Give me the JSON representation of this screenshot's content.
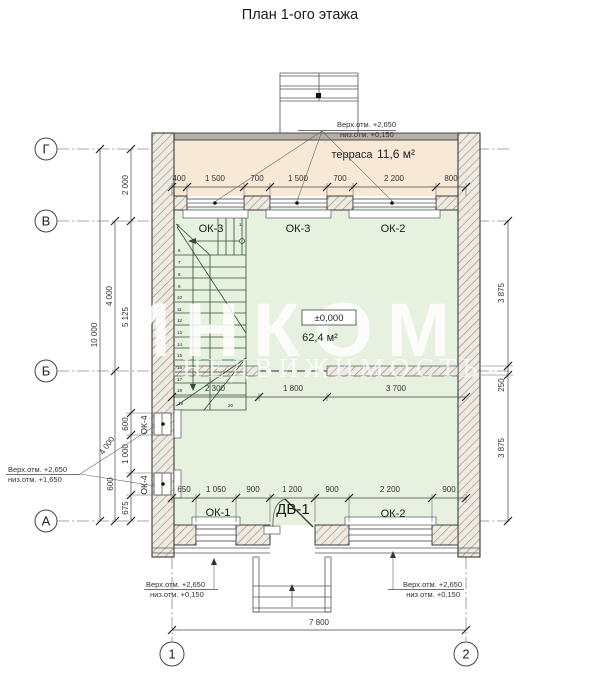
{
  "title": "План 1-ого этажа",
  "colors": {
    "terrace_fill": "#f8e9d7",
    "room_fill": "#e6f1e0",
    "wall_hatch_bg": "#efeae1",
    "wall_edge": "#3a3a3a",
    "watermark": "#ffffff"
  },
  "watermark": {
    "brand": "ИНКОМ",
    "sub": "НЕДВИЖИМОСТЬ"
  },
  "axes": {
    "row_g": "Г",
    "row_v": "В",
    "row_b": "Б",
    "row_a": "А",
    "col_1": "1",
    "col_2": "2"
  },
  "terrace": {
    "name": "терраса",
    "area": "11,6 м²"
  },
  "room": {
    "level": "±0,000",
    "area": "62,4 м²"
  },
  "openings": {
    "ok3a": "ОК-3",
    "ok3b": "ОК-3",
    "ok2_top": "ОК-2",
    "ok1": "ОК-1",
    "dv1": "ДВ-1",
    "ok2_bottom": "ОК-2",
    "ok4a": "ОК-4",
    "ok4b": "ОК-4"
  },
  "dims": {
    "top": [
      "400",
      "1 500",
      "700",
      "1 500",
      "700",
      "2 200",
      "800"
    ],
    "mid": [
      "2 300",
      "1 800",
      "3 700"
    ],
    "bottom": [
      "650",
      "1 050",
      "900",
      "1 200",
      "900",
      "2 200",
      "900"
    ],
    "left_total": "10 000",
    "left_2000": "2 000",
    "left_4000_upper": "4 000",
    "left_5125": "5 125",
    "left_4000_lower": "4 000",
    "left_600a": "600",
    "left_1000": "1 000",
    "left_600b": "600",
    "left_675": "675",
    "right_3875a": "3 875",
    "right_250": "250",
    "right_3875b": "3 875",
    "total_width": "7 800"
  },
  "stairs": {
    "numbers": [
      "1",
      "5",
      "6",
      "7",
      "8",
      "9",
      "10",
      "11",
      "12",
      "13",
      "14",
      "15",
      "16",
      "17",
      "18",
      "19",
      "20"
    ]
  },
  "notes": {
    "top": {
      "l1": "Верх.отм. +2,650",
      "l2": "низ.отм. +0,150"
    },
    "left": {
      "l1": "Верх.отм. +2,650",
      "l2": "низ.отм. +1,650"
    },
    "bottom_left": {
      "l1": "Верх.отм. +2,650",
      "l2": "низ.отм. +0,150"
    },
    "bottom_right": {
      "l1": "Верх.отм. +2,650",
      "l2": "низ.отм. +0,150"
    }
  }
}
